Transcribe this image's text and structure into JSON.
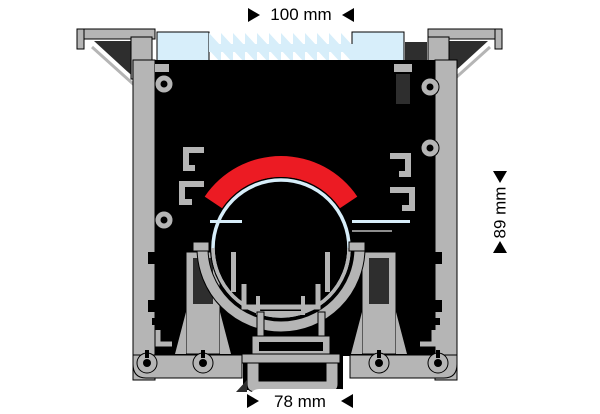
{
  "diagram": {
    "type": "technical-cross-section",
    "dimensions": {
      "top_width": "100 mm",
      "side_height": "89 mm",
      "bottom_width": "78 mm"
    },
    "colors": {
      "background": "#ffffff",
      "aluminum": "#b5b5b5",
      "aluminum-dark": "#8d8d8d",
      "shadow": "#2e2e2e",
      "cavity": "#000000",
      "outline": "#000000",
      "accent-red": "#ec1b23",
      "glass-blue": "#d7eefa",
      "text": "#000000"
    }
  }
}
